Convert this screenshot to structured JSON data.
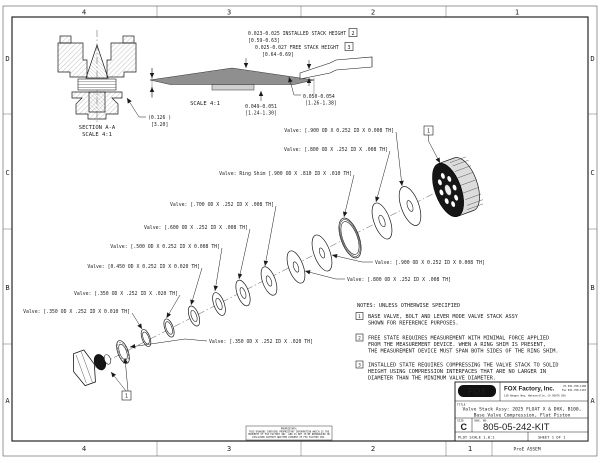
{
  "sheet": {
    "zones": {
      "cols": [
        "4",
        "3",
        "2",
        "1"
      ],
      "rows": [
        "D",
        "C",
        "B",
        "A"
      ]
    },
    "plot_note": "ProE ASSEM"
  },
  "section_view": {
    "title": "SECTION A-A",
    "scale": "SCALE 4:1",
    "dim_in": "(0.126 )",
    "dim_mm": "[3.20]"
  },
  "detail_view": {
    "scale": "SCALE 4:1",
    "installed_in": "0.023-0.025 INSTALLED STACK HEIGHT",
    "installed_flag": "2",
    "installed_mm": "[0.59-0.63]",
    "free_in": "0.025-0.027  FREE STACK HEIGHT",
    "free_flag": "3",
    "free_mm": "[0.64-0.69]",
    "dim_a_in": "0.049-0.051",
    "dim_a_mm": "[1.24-1.30]",
    "dim_b_in": "0.050-0.054",
    "dim_b_mm": "[1.26-1.38]"
  },
  "stack": {
    "balloon": "1",
    "labels": [
      {
        "text": "Valve: [.900 OD X 0.252 ID X 0.008 TH]"
      },
      {
        "text": "Valve: [.800 OD X .252 ID X .008 TH]"
      },
      {
        "text": "Valve: Ring Shim [.900 OD X .810 ID X .010 TH]"
      },
      {
        "text": "Valve: [.700 OD X .252 ID X .008 TH]"
      },
      {
        "text": "Valve: [.600 OD X .252 ID X .008 TH]"
      },
      {
        "text": "Valve: [.500 OD X 0.252 ID X 0.008 TH]"
      },
      {
        "text": "Valve: [0.450 OD X 0.252 ID X 0.020 TH]"
      },
      {
        "text": "Valve: [.350 OD X .252 ID X .020 TH]"
      },
      {
        "text": "Valve: [.350 OD X .252 ID X 0.010 TH]"
      },
      {
        "text": "Valve: [.350 OD X .252 ID X .020 TH]"
      },
      {
        "text": "Valve: [.900 OD X 0.252 ID X 0.008 TH]"
      },
      {
        "text": "Valve: [.800 OD X .252 ID X .008 TH]"
      }
    ]
  },
  "notes": {
    "header": "NOTES: UNLESS OTHERWISE SPECIFIED",
    "items": [
      {
        "flag": "1",
        "lines": [
          "BASE VALVE, BOLT AND LEVER MODE VALVE STACK ASSY",
          "SHOWN FOR REFERENCE PURPOSES."
        ]
      },
      {
        "flag": "2",
        "lines": [
          "FREE STATE REQUIRES MEASUREMENT WITH MINIMAL FORCE APPLIED",
          "FROM THE MEASUREMENT DEVICE. WHEN A RING SHIM IS PRESENT,",
          "THE MEASUREMENT DEVICE MUST SPAN BOTH SIDES OF THE RING SHIM."
        ]
      },
      {
        "flag": "3",
        "lines": [
          "INSTALLED STATE REQUIRES COMPRESSING THE VALVE STACK TO SOLID",
          "HEIGHT USING COMPRESSION INTERFACES THAT ARE NO LARGER IN",
          "DIAMETER THAN THE MINIMUM VALVE DIAMETER."
        ]
      }
    ]
  },
  "title_block": {
    "logo": "FOX",
    "company": "FOX Factory, Inc.",
    "address": "130 Hangar Way, Watsonville, CA 95076 USA",
    "phone": "Ph 831-768-1100",
    "fax": "Fax 831-768-1110",
    "title_label": "TITLE",
    "title_line1": "Valve Stack Assy: 2025 FLOAT X & DHX, B100,",
    "title_line2": "Base Valve Compression, Flat Piston",
    "size_label": "SIZE",
    "size": "C",
    "dwg_label": "DWG. NO.",
    "dwg_no": "805-05-242-KIT",
    "plot_scale": "PLOT SCALE 1.0:1",
    "sheet": "SHEET 1 OF 1"
  },
  "proprietary": {
    "lines": [
      "PROPRIETARY:",
      "THIS DRAWING CONTAINS PROPRIETARY INFORMATION WHICH IS THE",
      "PROPERTY OF FOX FACTORY INC. AND IS NOT TO BE REPRODUCED OR",
      "DISCLOSED WITHOUT WRITTEN CONSENT OF FOX FACTORY INC."
    ]
  }
}
